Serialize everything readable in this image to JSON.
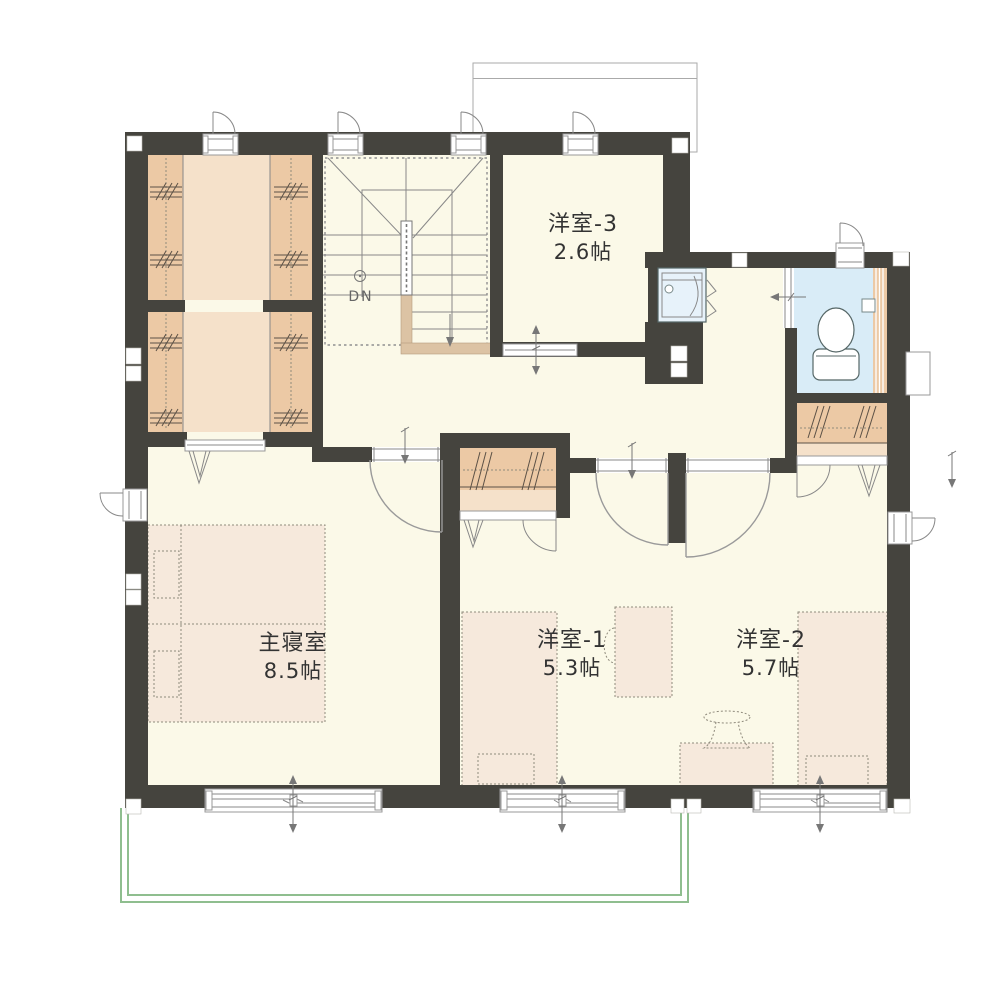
{
  "floor_plan": {
    "title": "2F floor plan",
    "rooms": [
      {
        "id": "master-bedroom",
        "name": "主寝室",
        "size": "8.5帖"
      },
      {
        "id": "western-room-1",
        "name": "洋室-1",
        "size": "5.3帖"
      },
      {
        "id": "western-room-2",
        "name": "洋室-2",
        "size": "5.7帖"
      },
      {
        "id": "western-room-3",
        "name": "洋室-3",
        "size": "2.6帖"
      }
    ],
    "stairs": {
      "label": "DN"
    },
    "fixtures": [
      "walk-in-closet",
      "closet",
      "toilet",
      "washstand",
      "double-bed",
      "single-bed",
      "desk",
      "chair",
      "stairs-down",
      "balcony",
      "sliding-window",
      "casement-window",
      "swing-door",
      "bifold-door"
    ]
  },
  "palette": {
    "wall": "#45443E",
    "floor": "#FBF9E8",
    "closet": "#ECC9A5",
    "closet-light": "#F5E1CA",
    "furniture": "#F6E9DC",
    "toilet": "#D9ECF7",
    "fixture-blue": "#E7F2FA",
    "balcony": "#8FBE8F",
    "landing": "#DCC3A4",
    "line": "#888888",
    "dot": "#8F8A7C",
    "text": "#333333"
  }
}
